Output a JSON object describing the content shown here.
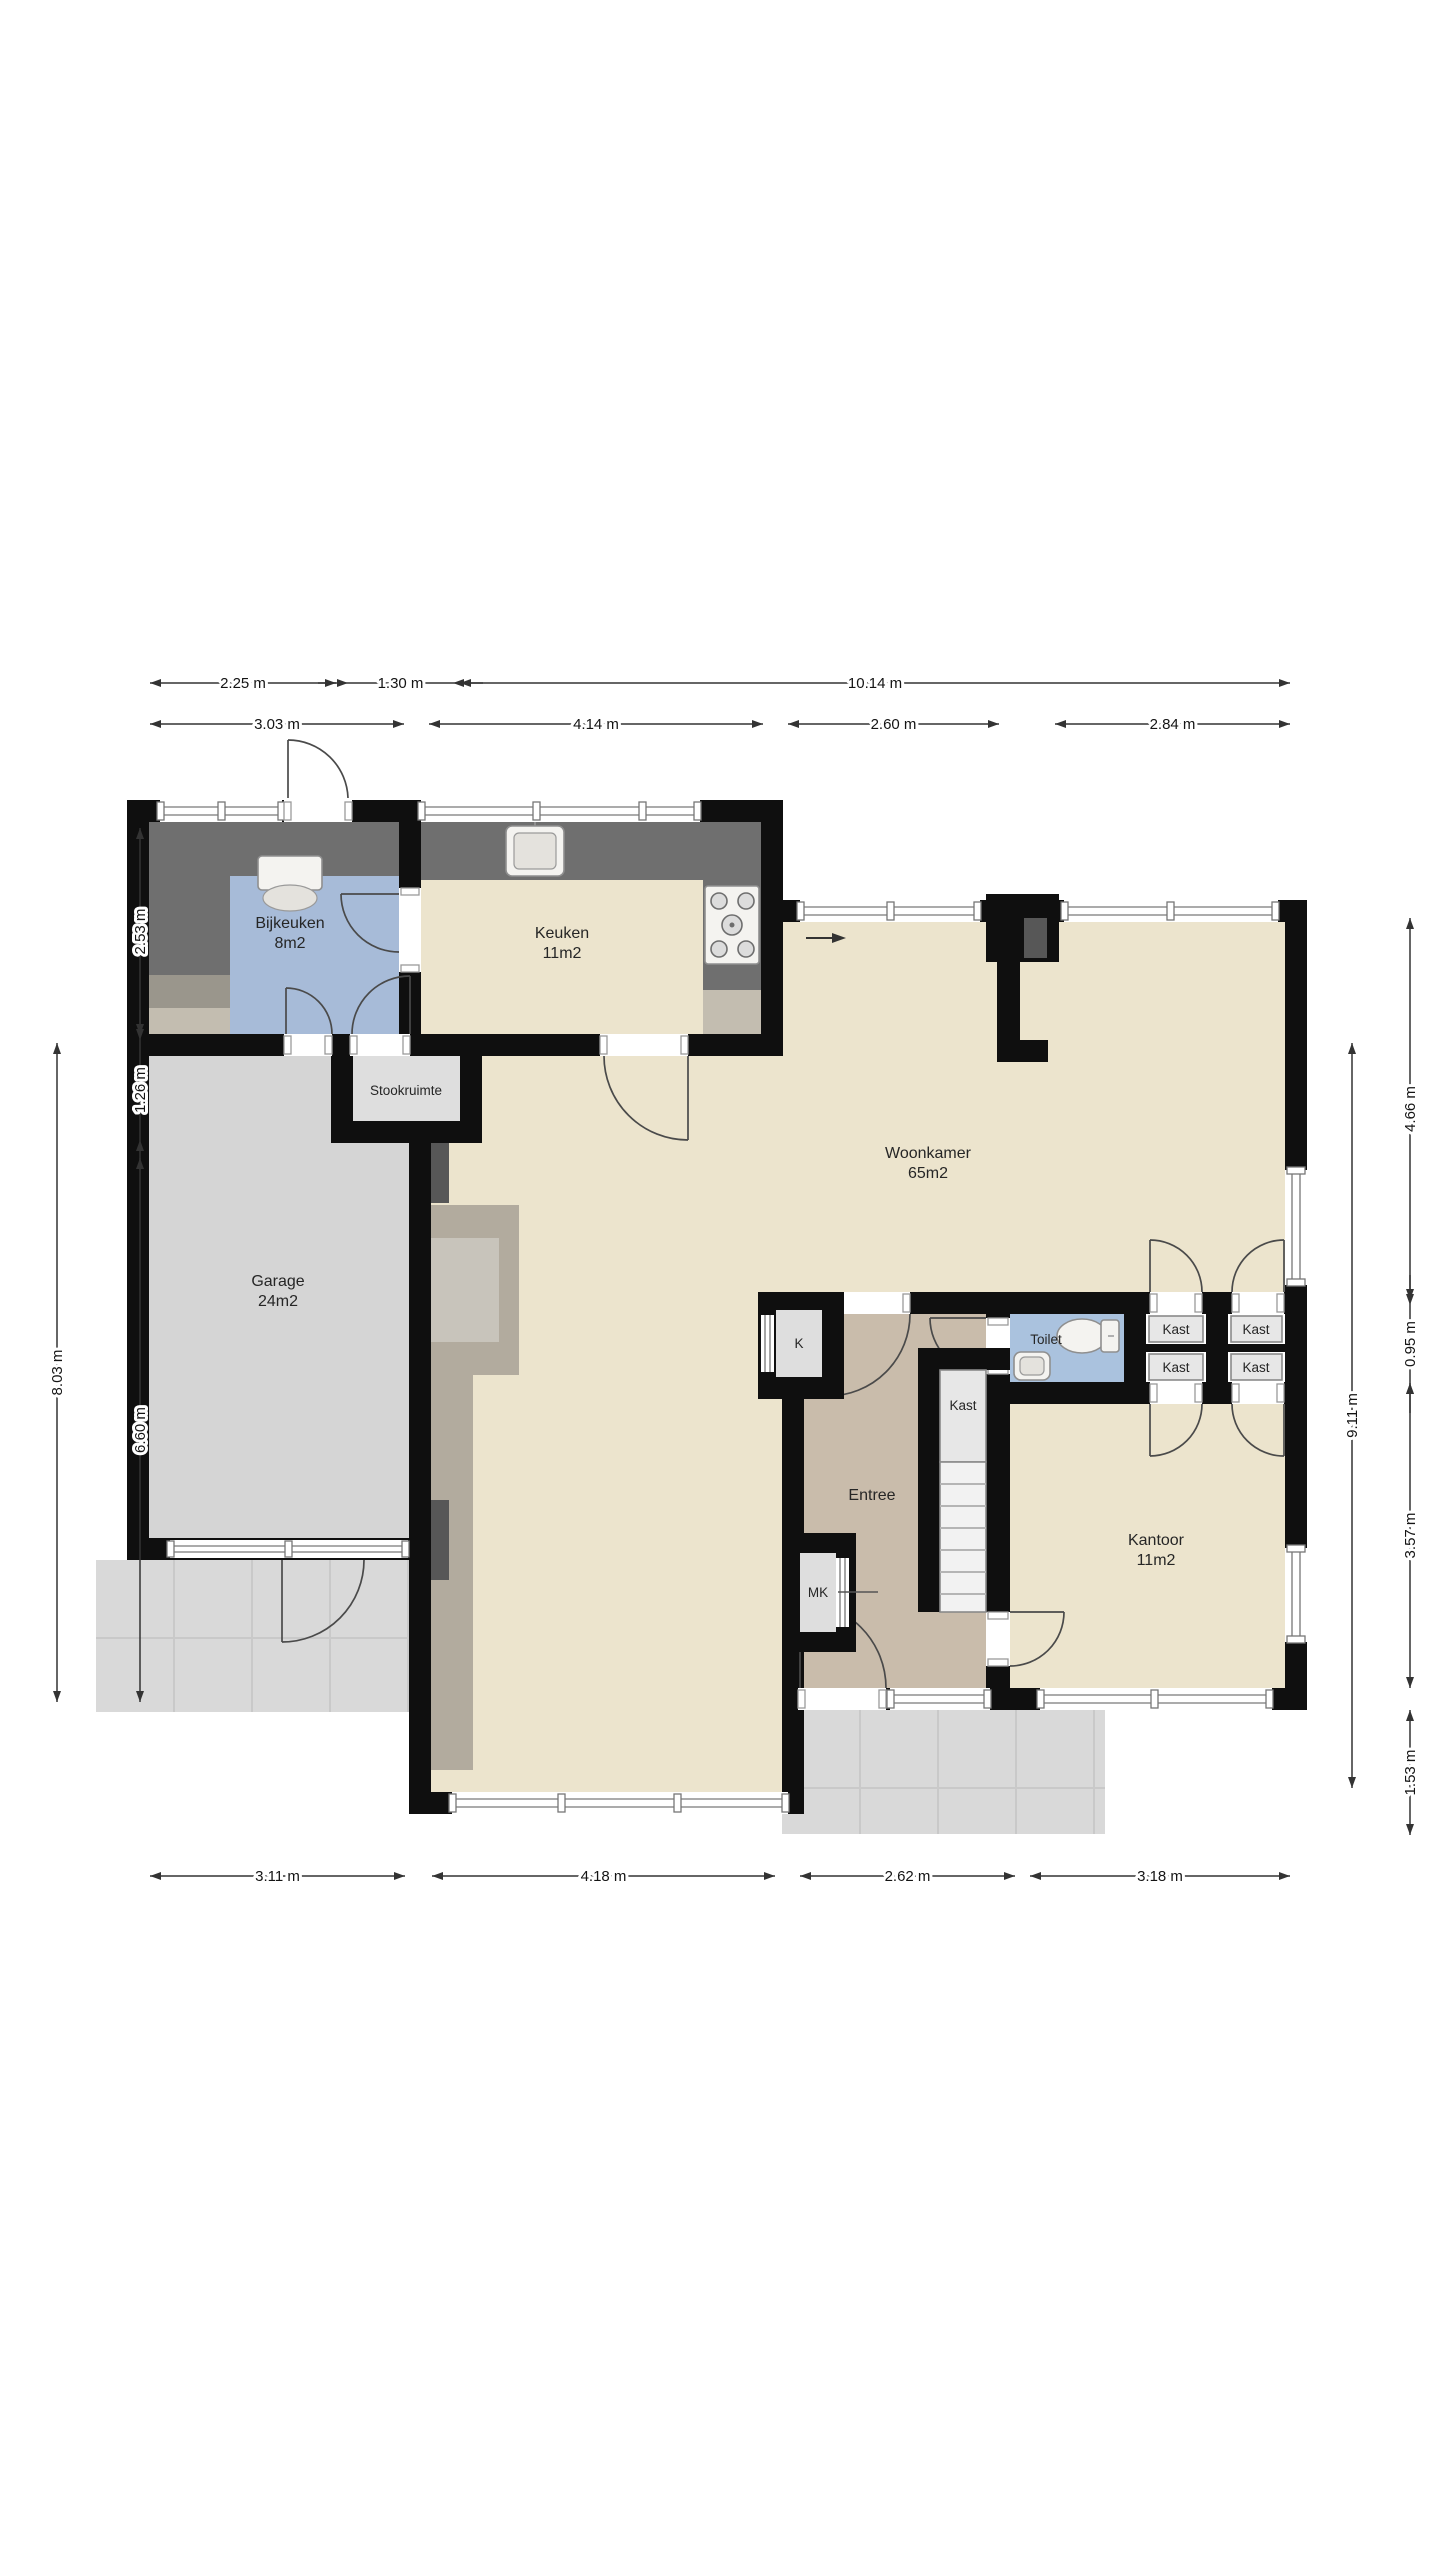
{
  "floorplan": {
    "rooms": {
      "bijkeuken": {
        "name": "Bijkeuken",
        "area": "8m2"
      },
      "keuken": {
        "name": "Keuken",
        "area": "11m2"
      },
      "woonkamer": {
        "name": "Woonkamer",
        "area": "65m2"
      },
      "garage": {
        "name": "Garage",
        "area": "24m2"
      },
      "stookruimte": {
        "name": "Stookruimte"
      },
      "entree": {
        "name": "Entree"
      },
      "toilet": {
        "name": "Toilet"
      },
      "kantoor": {
        "name": "Kantoor",
        "area": "11m2"
      },
      "k_closet": {
        "name": "K"
      },
      "mk_closet": {
        "name": "MK"
      }
    },
    "closet_labels": [
      "Kast",
      "Kast",
      "Kast",
      "Kast",
      "Kast"
    ],
    "dimensions": {
      "top_row1": [
        "2.25 m",
        "1.30 m",
        "10.14 m"
      ],
      "top_row2": [
        "3.03 m",
        "4.14 m",
        "2.60 m",
        "2.84 m"
      ],
      "bottom": [
        "3.11 m",
        "4.18 m",
        "2.62 m",
        "3.18 m"
      ],
      "left_outer": "8.03 m",
      "left_inner": [
        "2.53 m",
        "1.26 m",
        "6.60 m"
      ],
      "right_inner": "9.11 m",
      "right_outer": [
        "4.66 m",
        "0.95 m",
        "3.57 m",
        "1.53 m"
      ]
    },
    "colors": {
      "wall": "#0f0f0f",
      "floor_cream": "#ece4cd",
      "floor_tan": "#c9bcab",
      "floor_blue": "#a7bbd8",
      "floor_toilet": "#aac2de",
      "floor_gray": "#d5d5d5",
      "floor_light": "#dedede",
      "counter_dark": "#6f6f6f",
      "taupe": "#b2ab9e",
      "terrace": "#d9d9d9",
      "window_line": "#8f8f8f",
      "closet_fill": "#e7e7e7",
      "stairs": "#f2f2f2",
      "dim": "#333333"
    }
  }
}
